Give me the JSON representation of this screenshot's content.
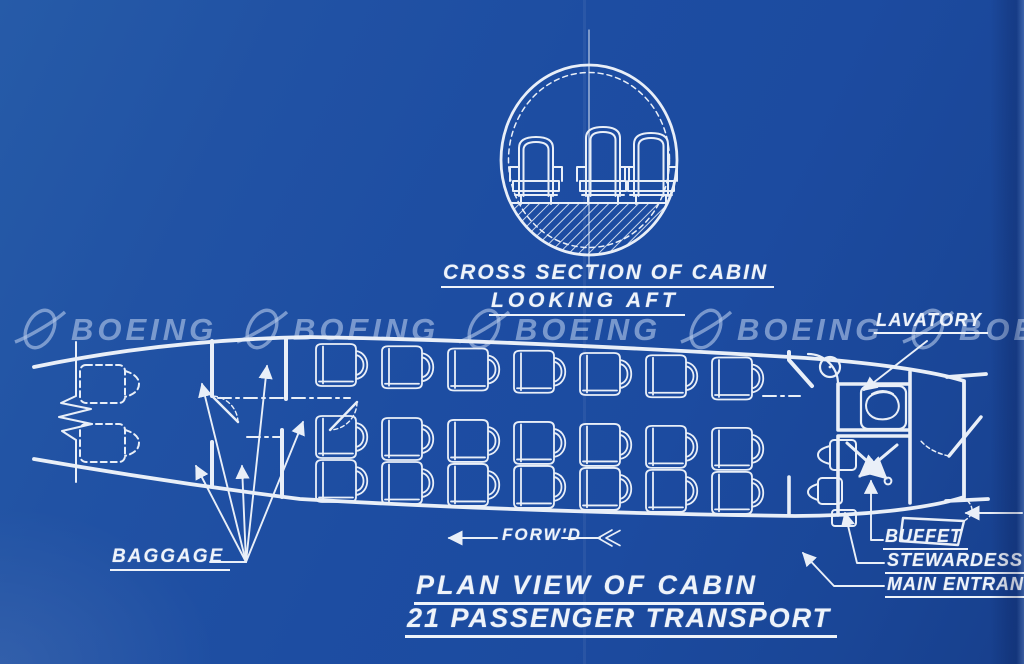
{
  "page": {
    "background_color": "#1d4da2",
    "line_color": "#e9eff8",
    "watermark_color": "rgba(178,199,232,0.62)"
  },
  "watermark": {
    "text": "BOEING",
    "count": 5
  },
  "cross_section": {
    "caption_line1": "CROSS SECTION OF CABIN",
    "caption_line2": "LOOKING AFT",
    "seat_count": 3
  },
  "plan_view": {
    "title_line1": "PLAN VIEW OF CABIN",
    "title_line2": "21 PASSENGER TRANSPORT",
    "forward_label": "FORW'D",
    "labels": {
      "lavatory": "LAVATORY",
      "baggage": "BAGGAGE",
      "buffet": "BUFFET",
      "stewardess": "STEWARDESS",
      "main_entrance": "MAIN ENTRANC"
    },
    "seating": {
      "columns": 7,
      "single_side_rows": 1,
      "double_side_rows": 2
    }
  }
}
